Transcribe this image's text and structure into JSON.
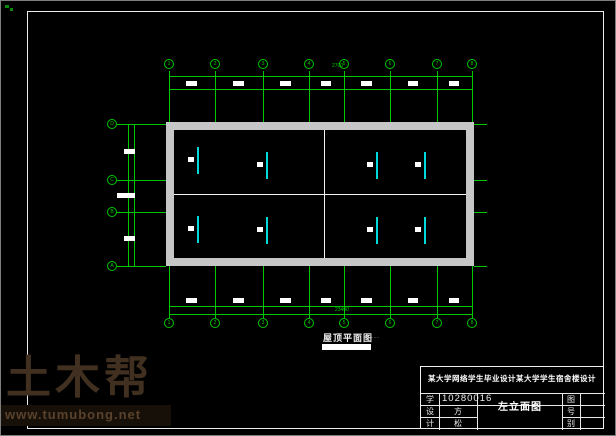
{
  "colors": {
    "line_green": "#00c800",
    "symbol_cyan": "#00d9d9",
    "wall_gray": "#c6c6c6",
    "frame_white": "#ececec",
    "watermark_brown": "#41301f",
    "watermark_url_brown": "#5a422c"
  },
  "plan": {
    "axis_top_labels": [
      "1",
      "2",
      "3",
      "4",
      "5",
      "6",
      "7",
      "8"
    ],
    "axis_bottom_labels": [
      "1",
      "2",
      "3",
      "4",
      "5",
      "6",
      "7",
      "8"
    ],
    "axis_left_labels": [
      "D",
      "C",
      "B",
      "A"
    ],
    "dims_top": [
      "3600",
      "3600",
      "3600",
      "2700",
      "3600",
      "3600",
      "2700"
    ],
    "dims_bottom": [
      "3600",
      "3600",
      "3600",
      "2700",
      "3600",
      "3600",
      "2700"
    ],
    "dims_left": [
      "4200",
      "2400",
      "4200"
    ],
    "total_dim_bottom": "23400",
    "bay_dim_above": "2700"
  },
  "caption": {
    "title": "屋顶平面图",
    "scale_dots": "···"
  },
  "titleblock": {
    "header": "某大学网络学生毕业设计某大学学生宿舍楼设计",
    "left_rows": [
      {
        "label": "学",
        "value": "10280016"
      },
      {
        "label": "设",
        "value": "方"
      },
      {
        "label": "计",
        "value": "松"
      }
    ],
    "drawing_name": "左立面图",
    "right_rows": [
      {
        "label": "图",
        "value": ""
      },
      {
        "label": "号",
        "value": ""
      },
      {
        "label": "别",
        "value": ""
      }
    ]
  },
  "watermark": {
    "brand": "土木帮",
    "url": "www.tumubong.net"
  }
}
